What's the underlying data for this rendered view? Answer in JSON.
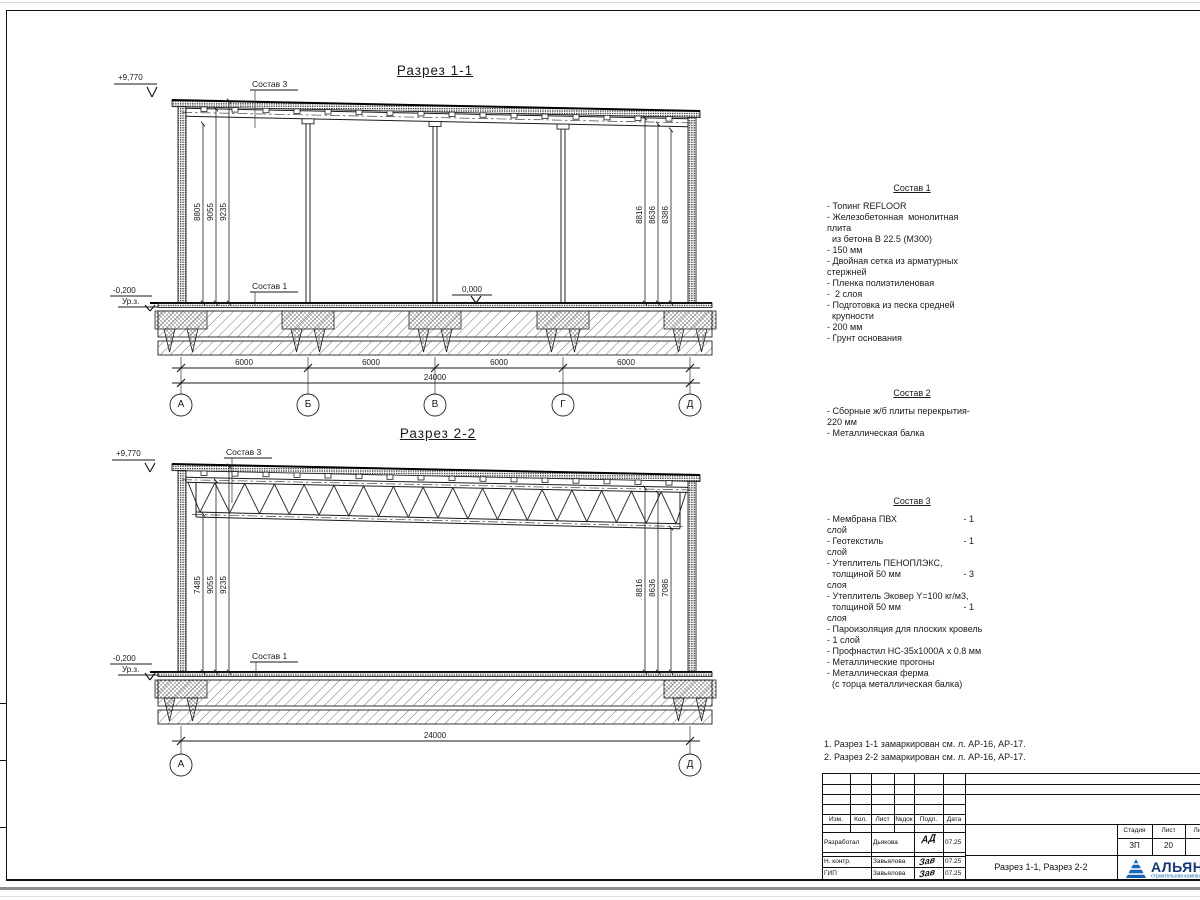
{
  "sections": {
    "s1": {
      "title": "Разрез 1-1",
      "elev_roof": "+9,770",
      "elev_zero": "0,000",
      "elev_ground": "-0,200",
      "ground_label": "Ур.з.",
      "callout_roof": "Состав 3",
      "callout_floor": "Состав 1",
      "dims_left": [
        "8805",
        "9055",
        "9235"
      ],
      "dims_right": [
        "8816",
        "8636",
        "8386"
      ],
      "span_dims": [
        "6000",
        "6000",
        "6000",
        "6000"
      ],
      "total_dim": "24000",
      "axes": [
        "А",
        "Б",
        "В",
        "Г",
        "Д"
      ]
    },
    "s2": {
      "title": "Разрез 2-2",
      "elev_roof": "+9,770",
      "elev_ground": "-0,200",
      "ground_label": "Ур.з.",
      "callout_roof": "Состав 3",
      "callout_floor": "Состав 1",
      "dims_left": [
        "7485",
        "9055",
        "9235"
      ],
      "dims_right": [
        "8816",
        "8636",
        "7086"
      ],
      "total_dim": "24000",
      "axes": [
        "А",
        "Д"
      ]
    }
  },
  "legend": {
    "sostav1": {
      "title": "Состав 1",
      "lines": [
        "- Топинг REFLOOR",
        "- Железобетонная  монолитная",
        "плита",
        "  из бетона В 22.5 (М300)",
        "- 150 мм",
        "- Двойная сетка из арматурных",
        "стержней",
        "- Пленка полиэтиленовая",
        "-  2 слоя",
        "- Подготовка из песка средней",
        "  крупности",
        "- 200 мм",
        "- Грунт основания"
      ]
    },
    "sostav2": {
      "title": "Состав 2",
      "lines": [
        "- Сборные ж/б плиты перекрытия-",
        "220 мм",
        "- Металлическая балка"
      ]
    },
    "sostav3": {
      "title": "Состав 3",
      "lines": [
        {
          "t": "- Мембрана ПВХ",
          "v": "- 1"
        },
        {
          "t": "слой",
          "v": ""
        },
        {
          "t": "- Геотекстиль",
          "v": "- 1"
        },
        {
          "t": "слой",
          "v": ""
        },
        {
          "t": "- Утеплитель ПЕНОПЛЭКС,",
          "v": ""
        },
        {
          "t": "  толщиной 50 мм",
          "v": "- 3"
        },
        {
          "t": "слоя",
          "v": ""
        },
        {
          "t": "- Утеплитель Эковер Y=100 кг/м3,",
          "v": ""
        },
        {
          "t": "  толщиной 50 мм",
          "v": "- 1"
        },
        {
          "t": "слоя",
          "v": ""
        },
        {
          "t": "- Пароизоляция для плоских кровель",
          "v": ""
        },
        {
          "t": "- 1 слой",
          "v": ""
        },
        {
          "t": "- Профнастил НС-35х1000А х 0.8 мм",
          "v": ""
        },
        {
          "t": "- Металлические прогоны",
          "v": ""
        },
        {
          "t": "- Металлическая ферма",
          "v": ""
        },
        {
          "t": "  (с торца металлическая балка)",
          "v": ""
        }
      ]
    }
  },
  "footnotes": [
    "1. Разрез 1-1 замаркирован см. л. АР-16, АР-17.",
    "2. Разрез 2-2 замаркирован см. л. АР-16, АР-17."
  ],
  "titleblock": {
    "cols": [
      "Изм.",
      "Кол.",
      "Лист",
      "№док",
      "Подп.",
      "Дата"
    ],
    "rows": [
      {
        "role": "Разработал",
        "name": "Дьякова",
        "sign": "АД",
        "date": "07.25"
      },
      {
        "role": "Н. контр.",
        "name": "Завьялова",
        "sign": "Зав",
        "date": "07.25"
      },
      {
        "role": "ГИП",
        "name": "Завьялова",
        "sign": "Зав",
        "date": "07.25"
      }
    ],
    "doc_title": "Разрез 1-1, Разрез 2-2",
    "stage_label": "Стадия",
    "stage": "ЗП",
    "sheet_label": "Лист",
    "sheet": "20",
    "sheets_label": "Листов",
    "sheets": "20",
    "company": "АЛЬЯНС",
    "company_sub": "строительная компания",
    "logo_color": "#1565b8"
  }
}
